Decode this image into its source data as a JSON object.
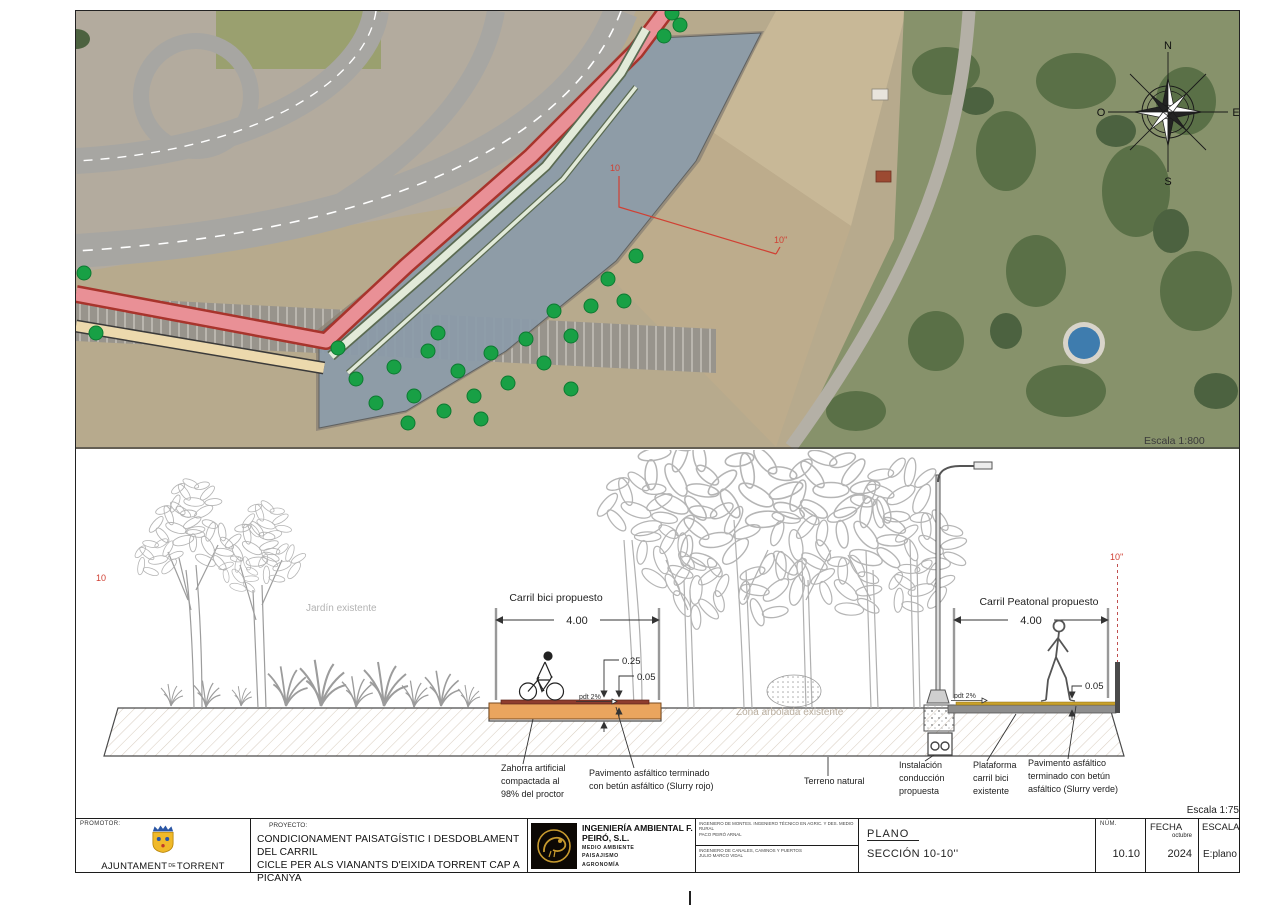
{
  "map": {
    "scale_label": "Escala 1:800",
    "compass": {
      "north": "N",
      "south": "S",
      "east": "E",
      "west": "O"
    },
    "section_marker_start": "10",
    "section_marker_end": "10''",
    "overlay_colors": {
      "corridor_blue": "#89aed4",
      "bike_pink": "#ef9aa2",
      "ped_tan": "#ecd9ad",
      "green_band": "#e2ead9",
      "tree_green": "#18a045",
      "marker_red": "#d04033"
    }
  },
  "section": {
    "scale_label": "Escala 1:75",
    "marker_left": "10",
    "marker_right": "10''",
    "garden_label": "Jardín existente",
    "woodland_label": "Zona arbolada existente",
    "bike_lane": {
      "title": "Carril bici propuesto",
      "width_dim": "4.00",
      "depth_dim": "0.25",
      "surface_dim": "0.05",
      "slope": "pdt 2%"
    },
    "ped_lane": {
      "title": "Carril Peatonal propuesto",
      "width_dim": "4.00",
      "surface_dim": "0.05",
      "slope": "pdt 2%"
    },
    "notes": {
      "zahorra": [
        "Zahorra artificial",
        "compactada al",
        "98% del proctor"
      ],
      "slurry_rojo": [
        "Pavimento asfáltico terminado",
        "con betún asfáltico (Slurry rojo)"
      ],
      "terreno": "Terreno natural",
      "instalacion": [
        "Instalación",
        "conducción",
        "propuesta"
      ],
      "plataforma": [
        "Plataforma",
        "carril bici",
        "existente"
      ],
      "slurry_verde": [
        "Pavimento asfáltico",
        "terminado con betún",
        "asfáltico (Slurry verde)"
      ]
    }
  },
  "titleblock": {
    "promotor_label": "PROMOTOR:",
    "promotor_name_a": "AJUNTAMENT",
    "promotor_name_sep": "DE",
    "promotor_name_b": "TORRENT",
    "proyecto_label": "PROYECTO:",
    "proyecto_line1": "CONDICIONAMENT PAISATGÍSTIC I DESDOBLAMENT DEL CARRIL",
    "proyecto_line2": "CICLE PER ALS VIANANTS D'EIXIDA TORRENT CAP A PICANYA",
    "company_name": "INGENIERÍA AMBIENTAL F. PEIRÓ, S.L.",
    "company_lines": [
      "MEDIO AMBIENTE",
      "PAISAJISMO",
      "AGRONOMÍA"
    ],
    "eng_row1_title": "INGENIERO DE MONTES. INGENIERO TÉCNICO EN AGRIC. Y DES. MEDIO RURAL",
    "eng_row1_name": "PACO PEIRÓ ARNAL",
    "eng_row2_title": "INGENIERO DE CANALES, CAMINOS Y PUERTOS",
    "eng_row2_name": "JULIO MARCO VIDAL",
    "plano_label": "PLANO",
    "plano_value": "SECCIÓN 10-10''",
    "num_label": "NÚM.",
    "num_value": "10.10",
    "fecha_label": "FECHA",
    "fecha_month": "octubre",
    "fecha_year": "2024",
    "escala_label": "ESCALA",
    "escala_value": "E:plano"
  }
}
